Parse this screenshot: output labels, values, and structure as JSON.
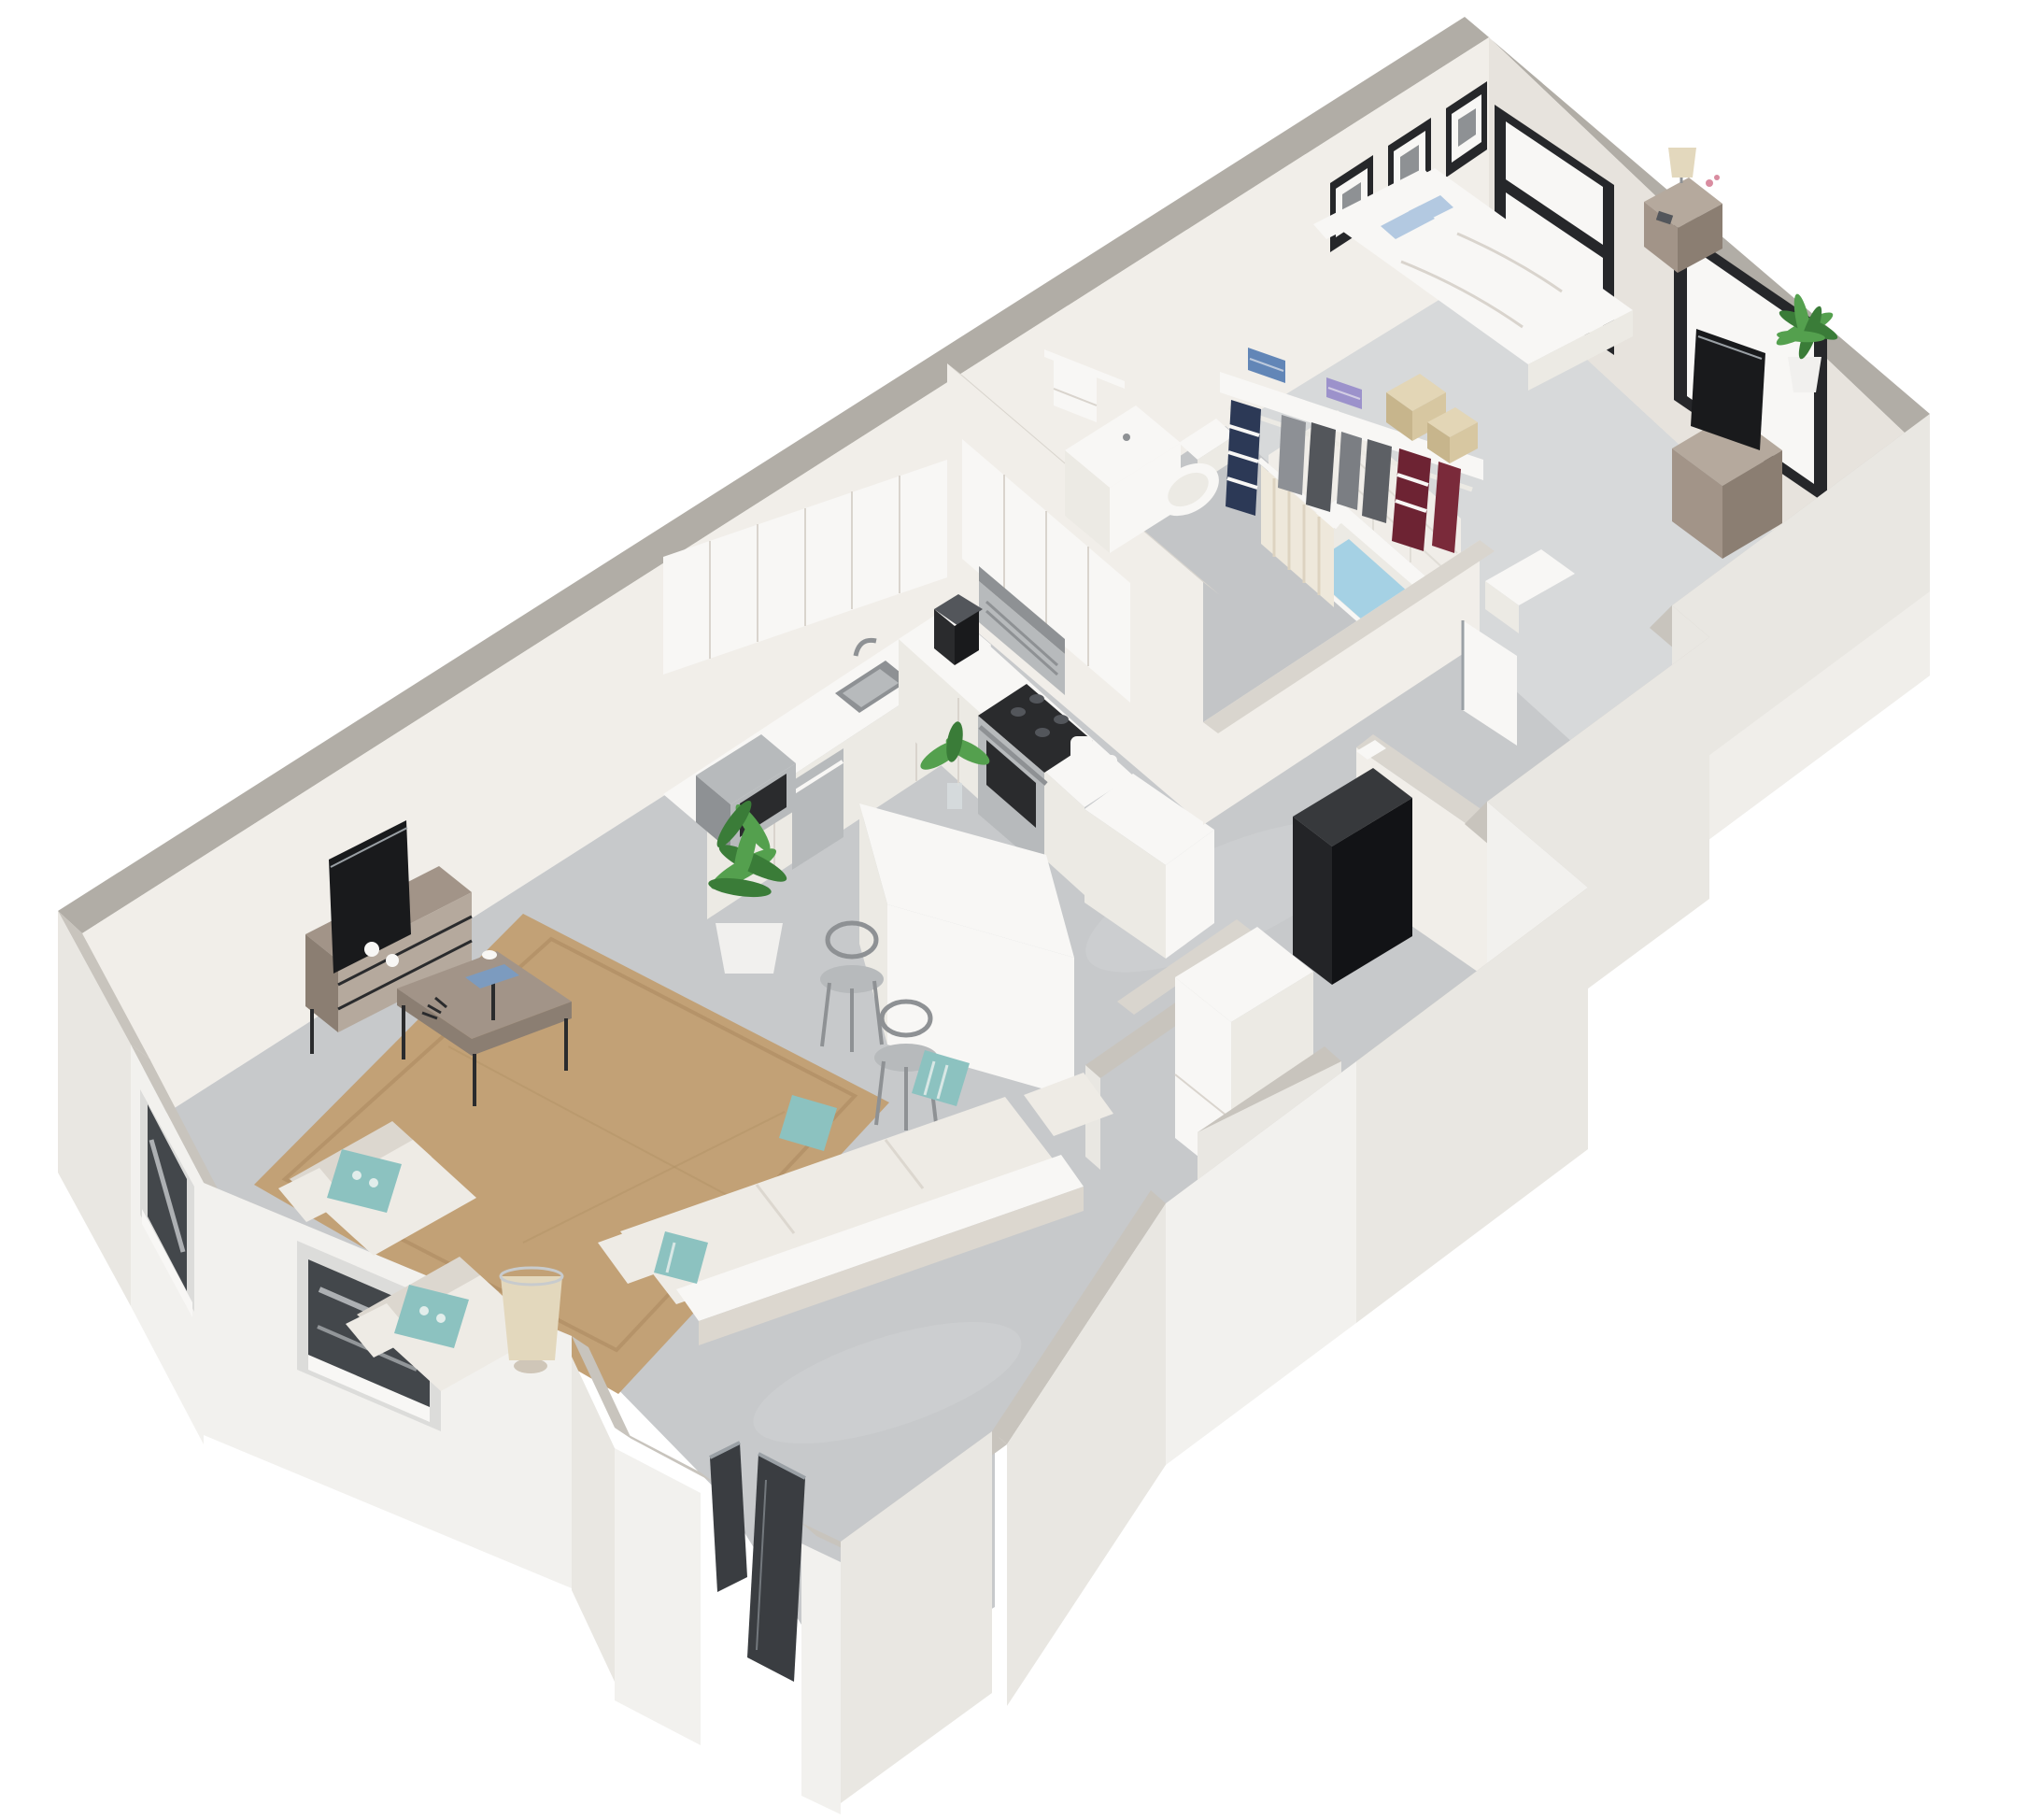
{
  "scene": {
    "type": "3d-isometric-floor-plan-render",
    "subject": "one-bedroom apartment dollhouse cutaway view",
    "background": "#ffffff",
    "rooms": [
      {
        "id": "living-room",
        "items": [
          "tv-media-console",
          "flat-screen-tv",
          "potted-plant",
          "jute-area-rug",
          "coffee-table",
          "three-seat-sofa",
          "armchair",
          "armchair",
          "floor-lamp",
          "accent-pillows",
          "corner-windows"
        ]
      },
      {
        "id": "dining-area",
        "items": [
          "white-island-table",
          "bar-stool",
          "bar-stool",
          "vase-plant"
        ]
      },
      {
        "id": "kitchen",
        "items": [
          "upper-cabinets",
          "base-cabinets",
          "countertop",
          "microwave",
          "dishwasher",
          "sink",
          "faucet",
          "coffee-maker",
          "range-hood",
          "gas-range",
          "canisters",
          "end-cabinet"
        ]
      },
      {
        "id": "bathroom",
        "items": [
          "vanity",
          "toilet",
          "bathtub",
          "shower-curtain",
          "towel-bar",
          "tile-surround"
        ]
      },
      {
        "id": "closet",
        "items": [
          "shelf",
          "hanging-rod",
          "hanging-clothes",
          "folded-towels",
          "storage-boxes"
        ]
      },
      {
        "id": "bedroom",
        "items": [
          "double-bed",
          "pillows",
          "headboard",
          "nightstand",
          "table-lamp",
          "wall-art-frames",
          "windows",
          "media-dresser",
          "flat-screen-tv",
          "palm-plant",
          "ac-unit",
          "door"
        ]
      },
      {
        "id": "utility",
        "items": [
          "water-heater",
          "hvac-unit",
          "closet-walls"
        ]
      },
      {
        "id": "entry",
        "items": [
          "open-front-door",
          "door-panel",
          "vestibule"
        ]
      }
    ]
  },
  "colors": {
    "bg": "#ffffff",
    "wallTopFar": "#b1ada6",
    "wallTopNear": "#c8c4bd",
    "wallTopInner": "#d9d5ce",
    "wallFace": "#f1eee9",
    "wallFaceShade": "#e7e3dd",
    "wallFaceDark": "#d9d4cd",
    "wallOuter": "#e9e7e2",
    "wallOuterLight": "#f2f1ee",
    "floor": "#c7c9cb",
    "floorLight": "#d5d7d8",
    "carpet": "#d7d9da",
    "bathFloor": "#c3c5c7",
    "tile": "#f0ede8",
    "tileLine": "#e0ddd6",
    "rug": "#c2a176",
    "rugDark": "#ab8b60",
    "wood": "#a29488",
    "woodDark": "#8b7e72",
    "woodLight": "#b5a99d",
    "black": "#2a2b2d",
    "tv": "#191a1c",
    "steel": "#b7babc",
    "steelDark": "#8e9194",
    "white": "#f8f7f5",
    "cream": "#eceae4",
    "sofa": "#eeebe5",
    "sofaShade": "#dcd7cf",
    "teal": "#8cc2c0",
    "bluePillow": "#b3c9e1",
    "navy": "#2c3956",
    "grayCloth": "#8d9095",
    "gray2": "#7b7e83",
    "charcoal": "#53565b",
    "charcoal2": "#5d6065",
    "maroon": "#6d2333",
    "clothRed": "#7a2a3a",
    "towelBlue": "#6286b7",
    "towelLav": "#9c92cb",
    "tan": "#d7c7a1",
    "tanDark": "#c7b58c",
    "tanLight": "#e3d6b6",
    "door": "#3a3d41",
    "doorEdge": "#9aa0a5",
    "curtain": "#eee8db",
    "curtainShade": "#ddd3c0",
    "lamp": "#e3d8bd",
    "lampBase": "#cfc6b8",
    "book": "#7c9bbf",
    "glass": "#43474b",
    "glassHi": "#c8cbcd",
    "frame": "#26272a",
    "green": "#54a04e",
    "greenDark": "#3a7c38",
    "water": "#a5d1e4",
    "pot": "#f1f0ee"
  }
}
